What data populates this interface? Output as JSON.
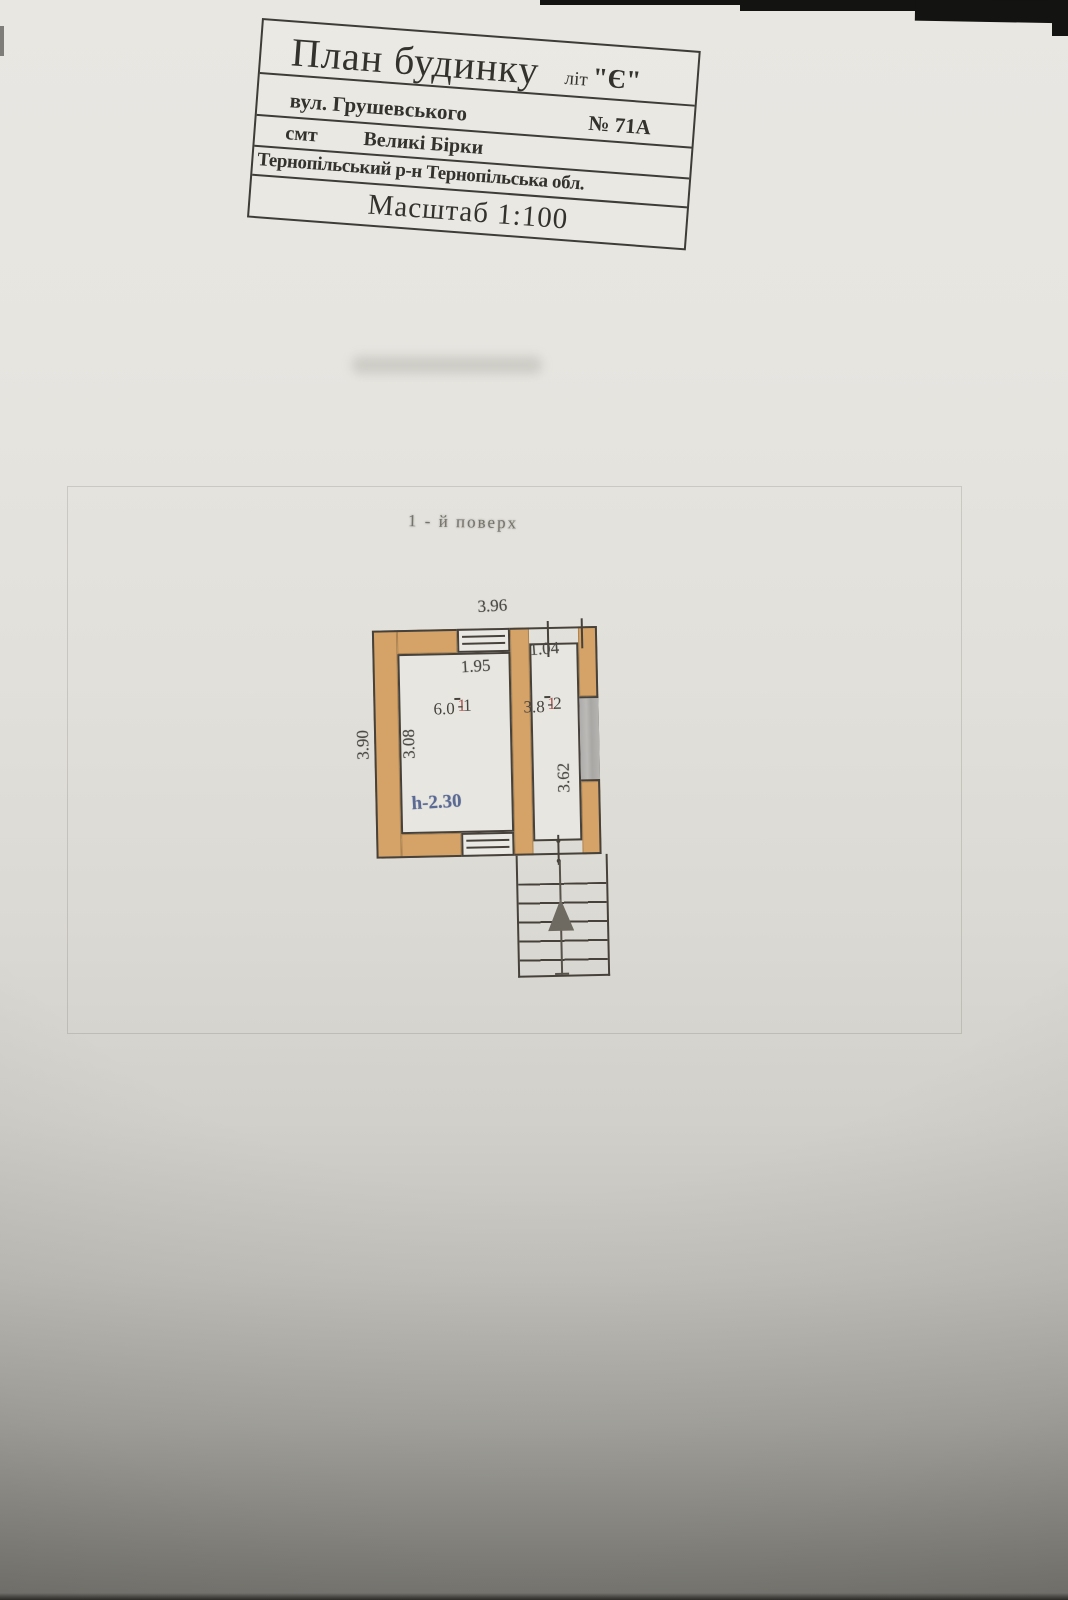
{
  "title_block": {
    "row1": {
      "title": "План будинку",
      "lit_label": "літ",
      "lit_value": "\"Є\""
    },
    "row2": {
      "street": "вул. Грушевського",
      "number": "№ 71А"
    },
    "row3": {
      "smt": "смт",
      "village": "Великі Бірки"
    },
    "row4": {
      "district": "Тернопільський р-н Тернопільська обл."
    },
    "row5": {
      "scale": "Масштаб 1:100"
    }
  },
  "floor_label": "1 - й  поверх",
  "plan": {
    "dimensions": {
      "top_width": "3.96",
      "room1_width": "1.95",
      "room2_width": "1.04",
      "outer_height": "3.90",
      "room1_height": "3.08",
      "room2_height": "3.62",
      "ceiling_height": "h-2.30"
    },
    "rooms": [
      {
        "num_red": "1",
        "num_rest": "-1",
        "area": "6.0"
      },
      {
        "num_red": "1",
        "num_rest": "-2",
        "area": "3.8"
      }
    ],
    "colors": {
      "wall_fill": "#d5a367",
      "window_fill": "#b4b2af",
      "line": "#46423b",
      "height_note_ink": "#5a6a93",
      "paper": "#e7e5e0",
      "photo_background": "#131311"
    }
  }
}
